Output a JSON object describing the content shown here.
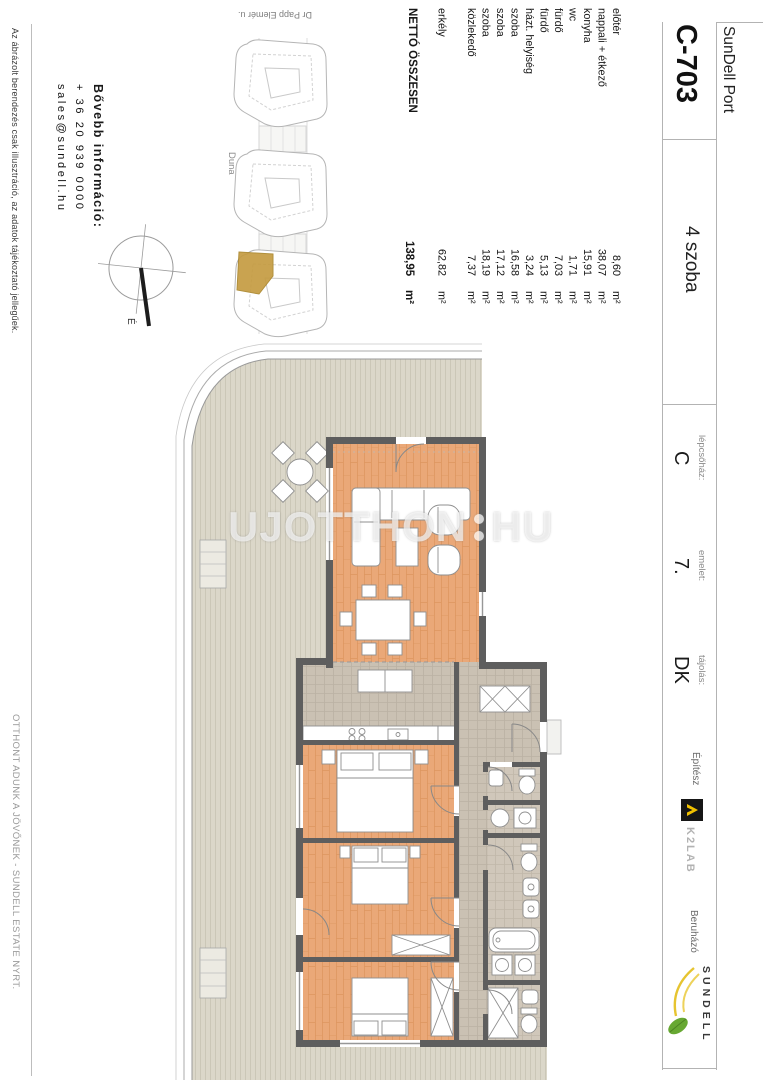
{
  "header": {
    "project_name": "SunDell Port",
    "unit_code": "C-703",
    "unit_rooms": "4 szoba",
    "details": [
      {
        "label": "lépcsőház:",
        "value": "C"
      },
      {
        "label": "emelet:",
        "value": "7."
      },
      {
        "label": "tájolás:",
        "value": "DK"
      }
    ],
    "architect": {
      "label": "Építész",
      "name": "K2LAB"
    },
    "developer": {
      "label": "Beruházó",
      "name": "SUNDELL"
    }
  },
  "room_table": {
    "rows": [
      {
        "name": "előtér",
        "value": "8,60",
        "unit": "m²"
      },
      {
        "name": "nappali + étkező",
        "value": "38,07",
        "unit": "m²"
      },
      {
        "name": "konyha",
        "value": "15,91",
        "unit": "m²"
      },
      {
        "name": "wc",
        "value": "1,71",
        "unit": "m²"
      },
      {
        "name": "fürdő",
        "value": "7,03",
        "unit": "m²"
      },
      {
        "name": "fürdő",
        "value": "5,13",
        "unit": "m²"
      },
      {
        "name": "házt. helyiség",
        "value": "3,24",
        "unit": "m²"
      },
      {
        "name": "szoba",
        "value": "16,58",
        "unit": "m²"
      },
      {
        "name": "szoba",
        "value": "17,12",
        "unit": "m²"
      },
      {
        "name": "szoba",
        "value": "18,19",
        "unit": "m²"
      },
      {
        "name": "közlekedő",
        "value": "7,37",
        "unit": "m²"
      }
    ],
    "balcony": {
      "name": "erkély",
      "value": "62,82",
      "unit": "m²"
    },
    "total": {
      "name": "NETTÓ ÖSSZESEN",
      "value": "138,95",
      "unit": "m²"
    }
  },
  "contact": {
    "heading": "Bővebb információ:",
    "phone": "+ 36 20 939 0000",
    "email": "sales@sundell.hu"
  },
  "site_plan": {
    "street": "Dr Papp Elemér u.",
    "river": "Duna"
  },
  "watermark": {
    "main": "UJOTTHON",
    "suffix": "HU"
  },
  "footer": {
    "disclaimer": "Az ábrázolt berendezés csak illusztráció, az adatok tájékoztató jellegűek.",
    "slogan": "OTTHONT ADUNK A JÖVŐNEK - SUNDELL ESTATE NYRT."
  },
  "colors": {
    "highlight_gold": "#c49a3e",
    "wall_gray": "#5e5e5e",
    "wood_floor": "#eaa878",
    "deck_beige": "#dbd7c9",
    "tile_gray": "#cac1b3",
    "k2lab_yellow": "#f2c200",
    "sundell_green": "#67a832",
    "sundell_yellow": "#e6c430"
  }
}
